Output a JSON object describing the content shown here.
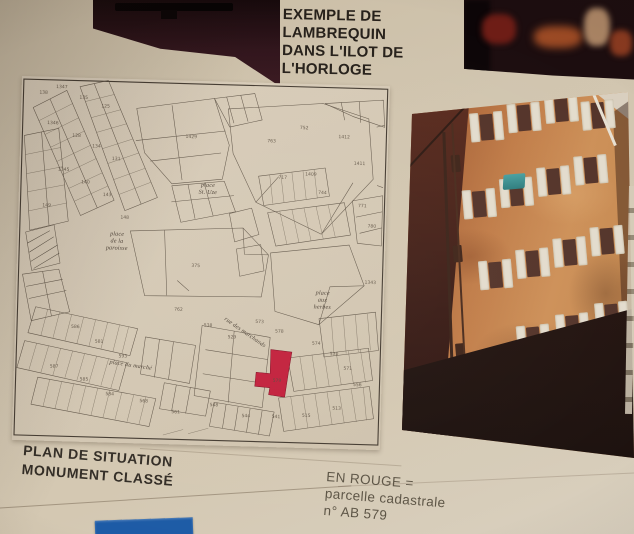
{
  "caption": {
    "lines": [
      "EXEMPLE DE",
      "LAMBREQUIN",
      "DANS L'ILOT DE",
      "L'HORLOGE"
    ]
  },
  "map_captions": {
    "plan": {
      "lines": [
        "PLAN DE SITUATION",
        "MONUMENT CLASSÉ"
      ]
    },
    "legend": {
      "lines": [
        "EN ROUGE =",
        "parcelle cadastrale",
        "n° AB 579"
      ]
    }
  },
  "map": {
    "highlighted_parcel": "AB 579",
    "place_labels": [
      {
        "t": "place",
        "x": 188,
        "y": 104
      },
      {
        "t": "St. Uze",
        "x": 188,
        "y": 111
      },
      {
        "t": "place",
        "x": 99,
        "y": 155
      },
      {
        "t": "de la",
        "x": 99,
        "y": 162
      },
      {
        "t": "paroisse",
        "x": 99,
        "y": 169
      },
      {
        "t": "place",
        "x": 305,
        "y": 208
      },
      {
        "t": "aux",
        "x": 305,
        "y": 215
      },
      {
        "t": "herbes",
        "x": 305,
        "y": 222
      },
      {
        "t": "place du marché",
        "x": 116,
        "y": 285,
        "r": 7
      },
      {
        "t": "rue des marchands",
        "x": 228,
        "y": 249,
        "r": 33
      }
    ],
    "parcel_numbers": [
      {
        "t": "138",
        "x": 22,
        "y": 16
      },
      {
        "t": "1347",
        "x": 40,
        "y": 10
      },
      {
        "t": "135",
        "x": 62,
        "y": 20
      },
      {
        "t": "125",
        "x": 84,
        "y": 28
      },
      {
        "t": "1346",
        "x": 32,
        "y": 46
      },
      {
        "t": "128",
        "x": 56,
        "y": 58
      },
      {
        "t": "134",
        "x": 76,
        "y": 68
      },
      {
        "t": "131",
        "x": 96,
        "y": 80
      },
      {
        "t": "1345",
        "x": 44,
        "y": 92
      },
      {
        "t": "140",
        "x": 66,
        "y": 104
      },
      {
        "t": "143",
        "x": 88,
        "y": 116
      },
      {
        "t": "149",
        "x": 28,
        "y": 128
      },
      {
        "t": "148",
        "x": 106,
        "y": 138
      },
      {
        "t": "1429",
        "x": 170,
        "y": 56,
        "s": 6
      },
      {
        "t": "1409",
        "x": 290,
        "y": 90,
        "s": 6
      },
      {
        "t": "763",
        "x": 250,
        "y": 58
      },
      {
        "t": "752",
        "x": 282,
        "y": 44
      },
      {
        "t": "1412",
        "x": 322,
        "y": 52
      },
      {
        "t": "1411",
        "x": 338,
        "y": 78
      },
      {
        "t": "717",
        "x": 262,
        "y": 94
      },
      {
        "t": "744",
        "x": 302,
        "y": 108
      },
      {
        "t": "771",
        "x": 342,
        "y": 120
      },
      {
        "t": "780",
        "x": 352,
        "y": 140
      },
      {
        "t": "375",
        "x": 178,
        "y": 184,
        "s": 6
      },
      {
        "t": "762",
        "x": 162,
        "y": 228
      },
      {
        "t": "538",
        "x": 192,
        "y": 243
      },
      {
        "t": "529",
        "x": 216,
        "y": 254
      },
      {
        "t": "573",
        "x": 243,
        "y": 238
      },
      {
        "t": "578",
        "x": 263,
        "y": 247
      },
      {
        "t": "579",
        "x": 262,
        "y": 296
      },
      {
        "t": "574",
        "x": 300,
        "y": 258
      },
      {
        "t": "570",
        "x": 318,
        "y": 268
      },
      {
        "t": "571",
        "x": 332,
        "y": 282
      },
      {
        "t": "556",
        "x": 342,
        "y": 298
      },
      {
        "t": "586",
        "x": 60,
        "y": 248
      },
      {
        "t": "581",
        "x": 84,
        "y": 262
      },
      {
        "t": "593",
        "x": 108,
        "y": 276
      },
      {
        "t": "587",
        "x": 40,
        "y": 288
      },
      {
        "t": "585",
        "x": 70,
        "y": 300
      },
      {
        "t": "584",
        "x": 96,
        "y": 314
      },
      {
        "t": "568",
        "x": 130,
        "y": 320
      },
      {
        "t": "561",
        "x": 162,
        "y": 330
      },
      {
        "t": "548",
        "x": 200,
        "y": 322
      },
      {
        "t": "544",
        "x": 232,
        "y": 332
      },
      {
        "t": "541",
        "x": 262,
        "y": 332
      },
      {
        "t": "515",
        "x": 292,
        "y": 330
      },
      {
        "t": "513",
        "x": 322,
        "y": 322
      },
      {
        "t": "1343",
        "x": 352,
        "y": 196
      }
    ]
  },
  "colors": {
    "paper": "#d1c5af",
    "red_parcel": "#c2203c",
    "blue_card": "#1d5ba6",
    "facade": "#c07c48",
    "awning_teal": "#3f8f8e"
  }
}
